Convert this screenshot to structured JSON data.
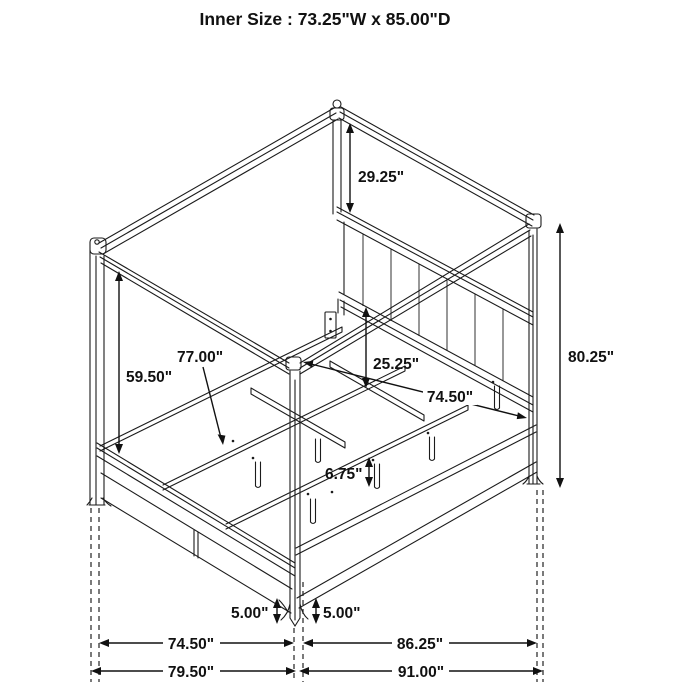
{
  "title": "Inner Size : 73.25\"W x 85.00\"D",
  "dimensions": {
    "canopy_to_headboard": "29.25\"",
    "post_height": "80.25\"",
    "footboard_to_canopy": "59.50\"",
    "slat_length": "77.00\"",
    "headboard_to_rail": "25.25\"",
    "side_rail_length": "74.50\"",
    "center_leg_height": "6.75\"",
    "foot_clearance_left": "5.00\"",
    "foot_clearance_right": "5.00\"",
    "width_inner": "74.50\"",
    "width_overall": "79.50\"",
    "depth_inner": "86.25\"",
    "depth_overall": "91.00\""
  }
}
